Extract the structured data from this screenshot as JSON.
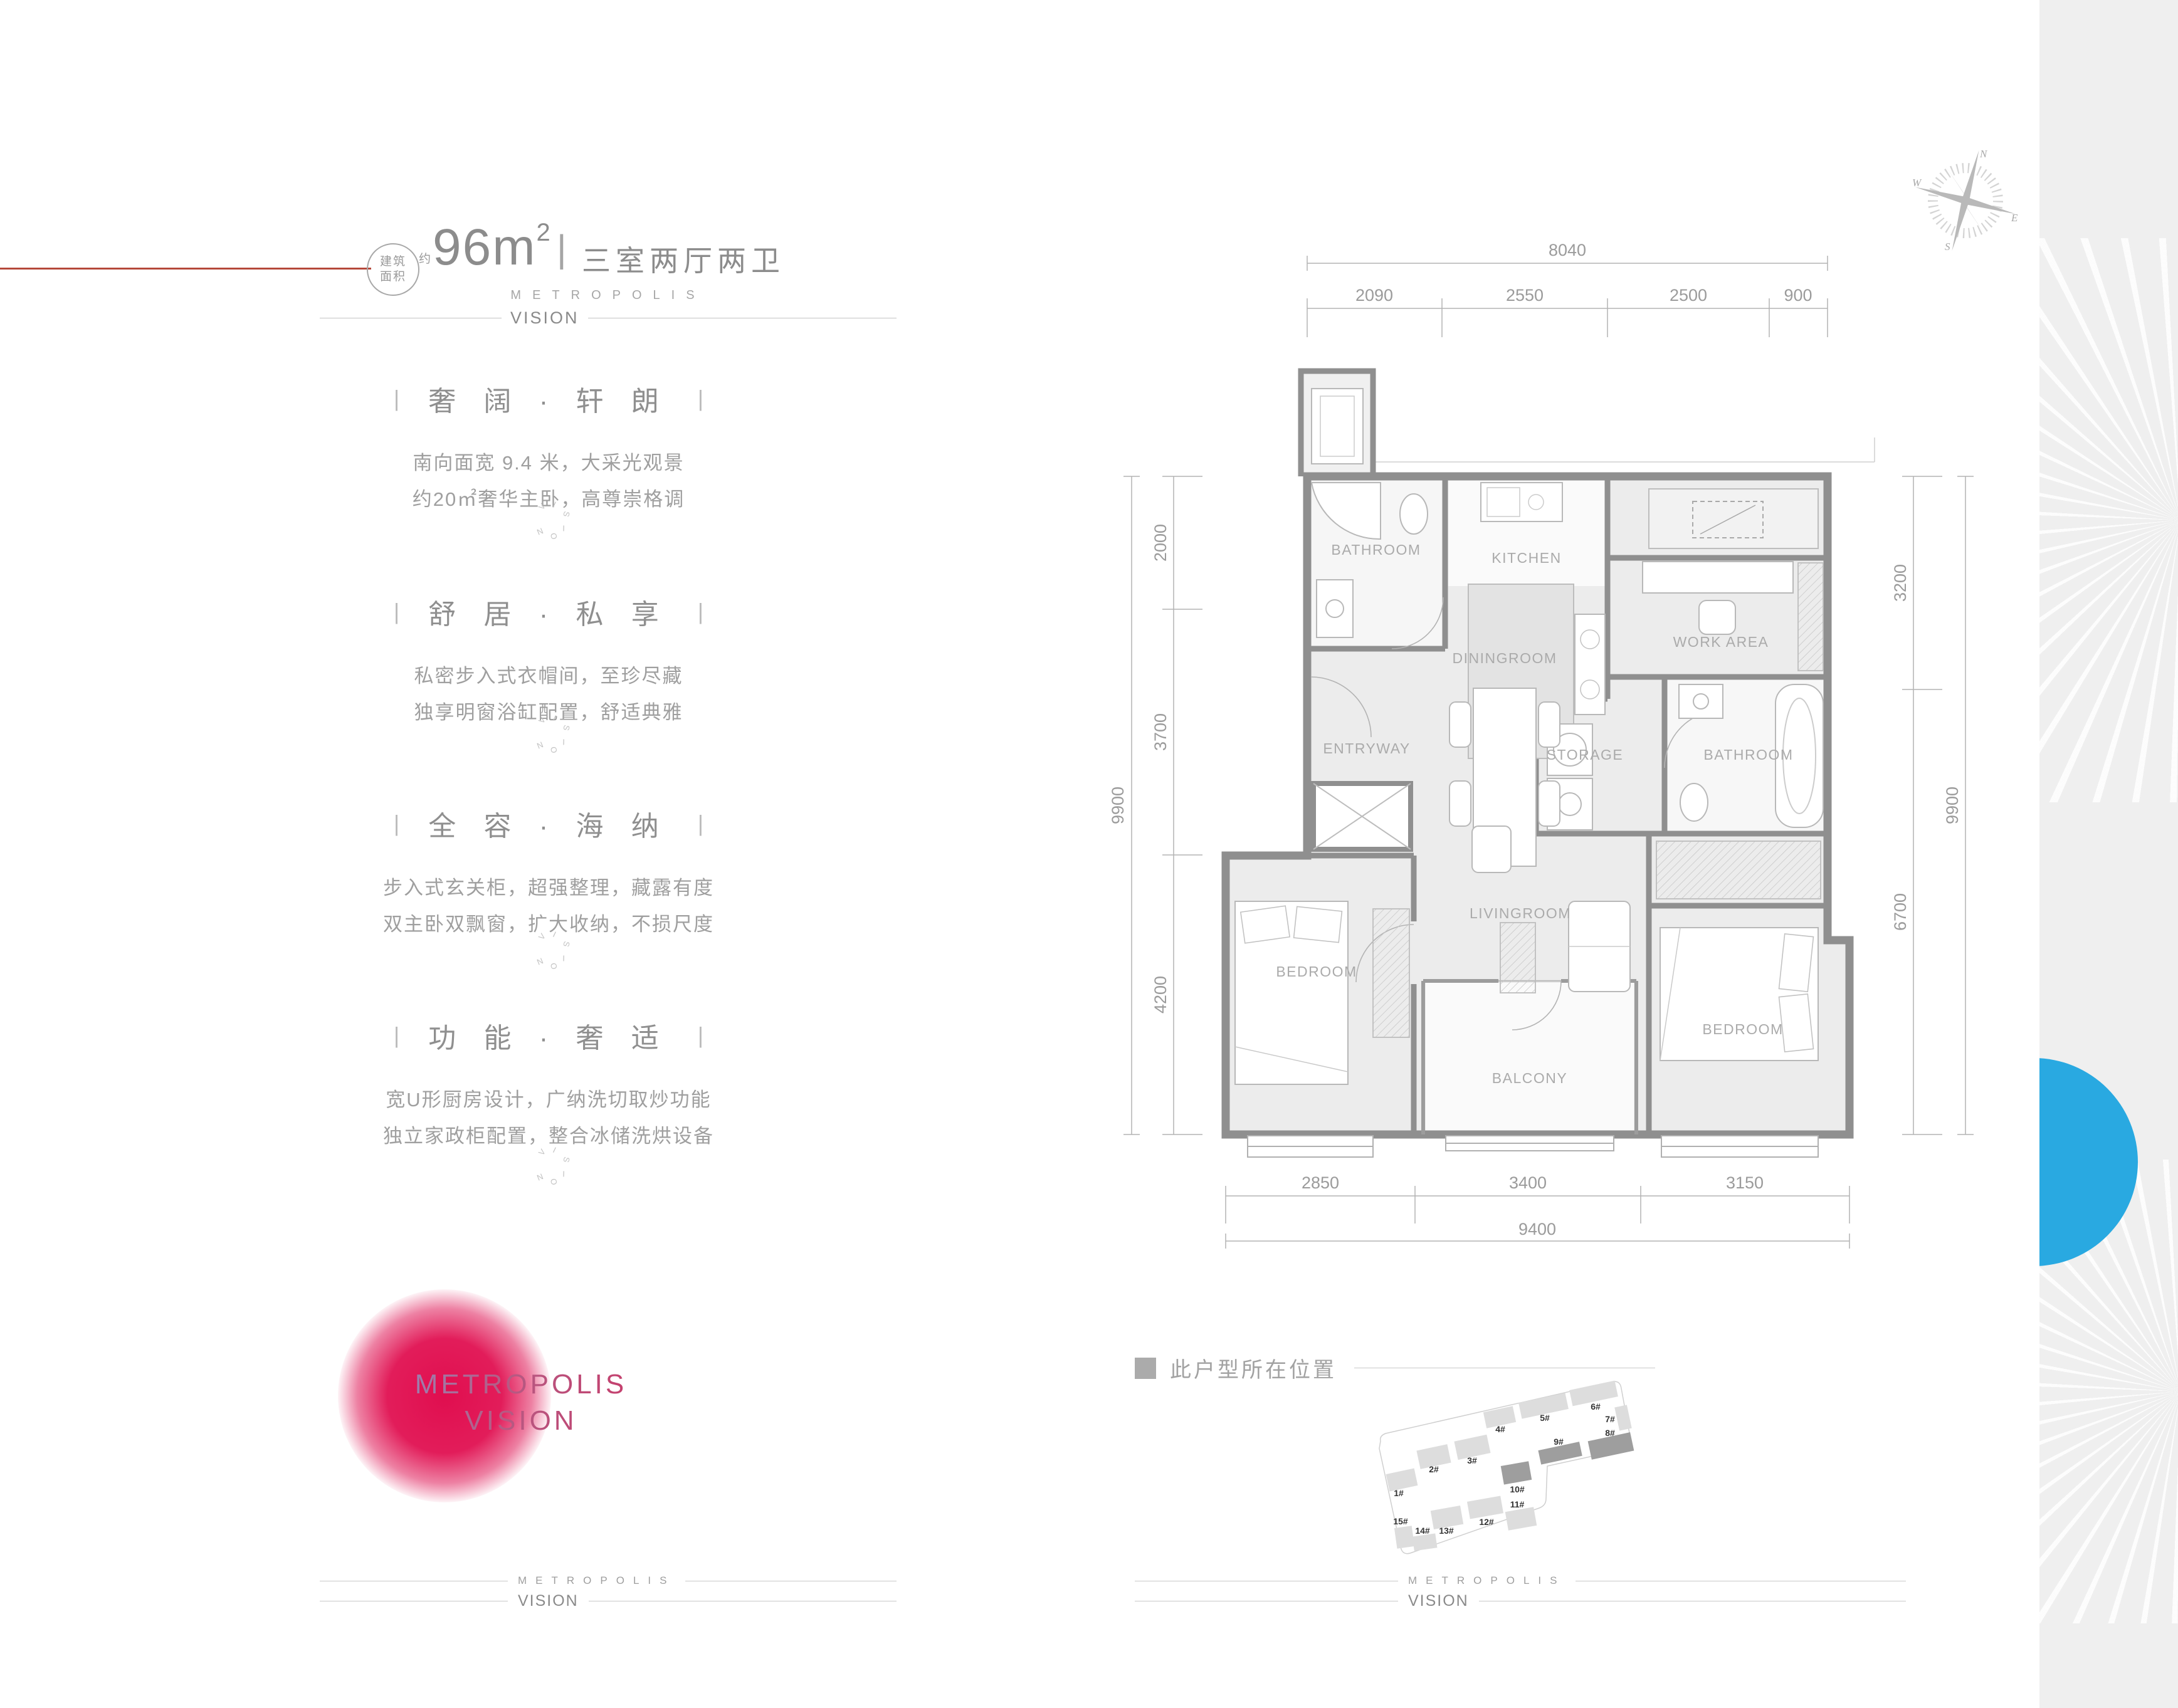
{
  "colors": {
    "accent_red": "#b5483a",
    "logo_red": "#df0448",
    "blue_circle": "#29a9e1",
    "wall_gray": "#8f8f8f"
  },
  "header": {
    "badge_line1": "建筑",
    "badge_line2": "面积",
    "approx": "约",
    "area_main": "96m",
    "area_exp": "2",
    "separator": "|",
    "subtitle": "三室两厅两卫",
    "brand_top": "METROPOLIS",
    "brand_bottom": "VISION"
  },
  "ui": {
    "bar": "|"
  },
  "sections": [
    {
      "heading": "奢 阔 · 轩 朗",
      "line1": "南向面宽 9.4 米，大采光观景",
      "line2": "约20㎡奢华主卧，高尊崇格调"
    },
    {
      "heading": "舒 居 · 私 享",
      "line1": "私密步入式衣帽间，至珍尽藏",
      "line2": "独享明窗浴缸配置，舒适典雅"
    },
    {
      "heading": "全 容 · 海 纳",
      "line1": "步入式玄关柜，超强整理，藏露有度",
      "line2": "双主卧双飘窗，扩大收纳，不损尺度"
    },
    {
      "heading": "功 能 · 奢 适",
      "line1": "宽U形厨房设计，广纳洗切取炒功能",
      "line2": "独立家政柜配置，整合冰储洗烘设备"
    }
  ],
  "decor": {
    "word": "VISION"
  },
  "logo": {
    "line1": "METROPOLIS",
    "line2": "VISION"
  },
  "floorplan": {
    "rooms": {
      "bathroom1": "BATHROOM",
      "kitchen": "KITCHEN",
      "workarea": "WORK AREA",
      "entryway": "ENTRYWAY",
      "diningroom": "DININGROOM",
      "storage": "STORAGE",
      "bathroom2": "BATHROOM",
      "livingroom": "LIVINGROOM",
      "bedroom_left": "BEDROOM",
      "balcony": "BALCONY",
      "bedroom_right": "BEDROOM"
    },
    "dims": {
      "top_total": "8040",
      "top_segments": [
        "2090",
        "2550",
        "2500",
        "900"
      ],
      "left_total": "9900",
      "left_segments": [
        "2000",
        "3700",
        "4200"
      ],
      "right_total": "9900",
      "right_segments": [
        "3200",
        "6700"
      ],
      "bottom_total": "9400",
      "bottom_segments": [
        "2850",
        "3400",
        "3150"
      ]
    },
    "compass": {
      "n": "N",
      "e": "E",
      "s": "S",
      "w": "W"
    }
  },
  "siteplan": {
    "legend": "此户型所在位置",
    "buildings": [
      {
        "label": "1#",
        "dark": false
      },
      {
        "label": "2#",
        "dark": false
      },
      {
        "label": "3#",
        "dark": false
      },
      {
        "label": "4#",
        "dark": false
      },
      {
        "label": "5#",
        "dark": false
      },
      {
        "label": "6#",
        "dark": false
      },
      {
        "label": "7#",
        "dark": false
      },
      {
        "label": "8#",
        "dark": true
      },
      {
        "label": "9#",
        "dark": true
      },
      {
        "label": "10#",
        "dark": true
      },
      {
        "label": "11#",
        "dark": false
      },
      {
        "label": "12#",
        "dark": false
      },
      {
        "label": "13#",
        "dark": false
      },
      {
        "label": "14#",
        "dark": false
      },
      {
        "label": "15#",
        "dark": false
      }
    ]
  },
  "footer": {
    "brand_top": "METROPOLIS",
    "brand_bottom": "VISION"
  }
}
